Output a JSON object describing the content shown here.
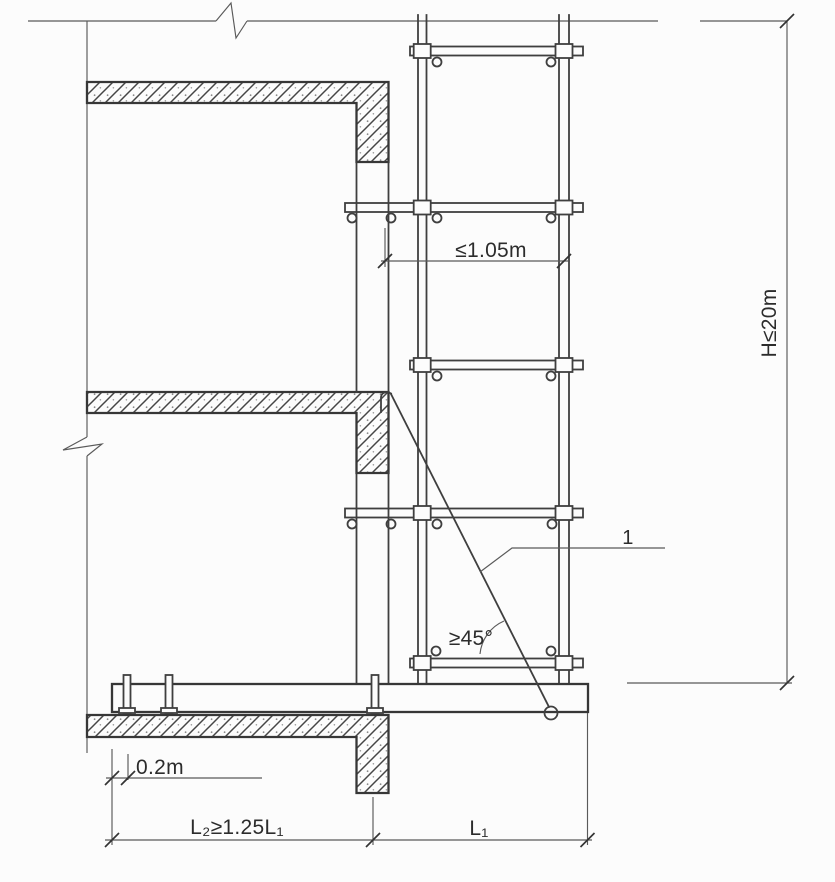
{
  "figure": {
    "type": "construction-detail-drawing",
    "subject": "Cantilevered scaffold elevation section detail",
    "labels": {
      "tie_spacing": "≤1.05m",
      "total_height": "H≤20m",
      "anchor_offset": "0.2m",
      "inner_beam_length": "L₂≥1.25L₁",
      "cantilever_length": "L₁",
      "brace_angle": "≥45°",
      "callout_1": "1"
    },
    "colors": {
      "background": "#fcfcfc",
      "heavy_line": "#373737",
      "medium_line": "#3f3f3f",
      "thin_line": "#5a5a5a",
      "text": "#2c2c2c"
    }
  }
}
